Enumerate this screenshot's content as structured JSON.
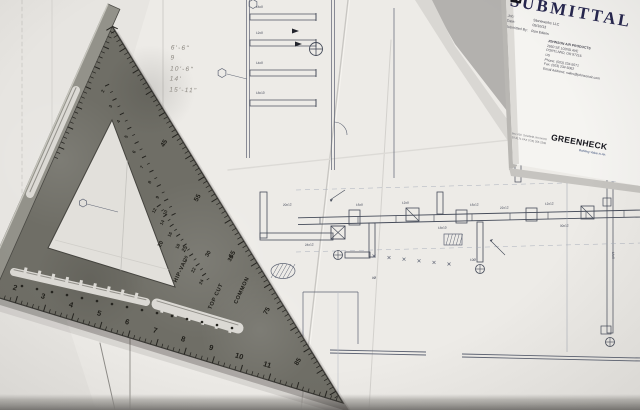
{
  "scene": {
    "subject": "construction blueprints on a table with a metal speed square and a submittal cover sheet"
  },
  "submittal": {
    "title": "SUBMITTAL",
    "fields": [
      {
        "label": "Job:",
        "value": "Stoneworks LLC"
      },
      {
        "label": "Date:",
        "value": "05/10/13"
      },
      {
        "label": "Submitted By:",
        "value": "Ron Edens"
      }
    ],
    "address_lines": [
      "JOHNSON AIR PRODUCTS",
      "2950 SE 102ND AVE",
      "PORTLAND, OR 97216",
      "US",
      "Phone: (503) 234-5071",
      "Fax: (503) 234-5062",
      "Email Address: sales@johnsonair.com"
    ],
    "logo": {
      "brand": "GREENHECK",
      "tagline": "Building Value in Air.",
      "po_line": "P.O. Box 410",
      "city_line": "Schofield, WI 54476",
      "phone_line": "(715) 359-6171  FAX (715) 355-2399"
    }
  },
  "speed_square": {
    "bottom_scale": [
      "2",
      "3",
      "4",
      "5",
      "6",
      "7",
      "8",
      "9",
      "10",
      "11"
    ],
    "degree_scale": [
      "45",
      "55",
      "65",
      "75",
      "85"
    ],
    "pivot_scale": [
      "20",
      "25",
      "30",
      "35"
    ],
    "window_scale": [
      "2",
      "3",
      "4",
      "5",
      "6",
      "7",
      "8",
      "9",
      "10"
    ],
    "rafter_scale": [
      "12",
      "14",
      "16",
      "18",
      "20",
      "22",
      "24"
    ],
    "labels": {
      "hip_val": "HIP-VAL",
      "top_cut": "TOP CUT",
      "common": "COMMON"
    }
  },
  "blueprint": {
    "pencil_notes": [
      "6'-6\"",
      "9",
      "10'-6\"",
      "14'",
      "15'-11\""
    ],
    "duct_labels": [
      "20x12",
      "24x12",
      "16x8",
      "12x8",
      "22x12",
      "10Ø",
      "8Ø",
      "30x12",
      "14x8",
      "18x10",
      "12x12",
      "16x12"
    ]
  },
  "colors": {
    "table": "#aeaca9",
    "table_dark": "#7c7a77",
    "paper_main": "#edebe7",
    "paper_left": "#e7e5e1",
    "paper_submittal": "#f5f4f1",
    "ink_line": "#5c6272",
    "duct_line": "#454b59",
    "pencil": "#8a867f",
    "square_body": "#6f6e66",
    "square_lip": "#93928a",
    "square_edge": "#3a3935",
    "engraving": "#24231f",
    "title_navy": "#26264e"
  }
}
